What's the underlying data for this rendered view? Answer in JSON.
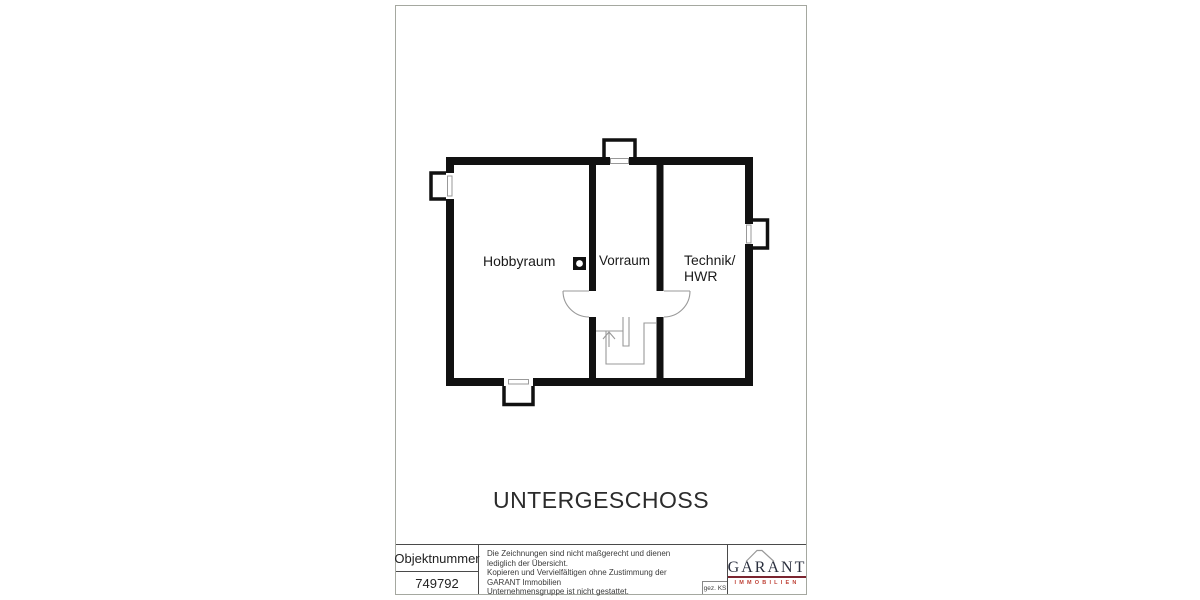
{
  "sheet": {
    "floor_label": "UNTERGESCHOSS",
    "rooms": {
      "hobbyraum": "Hobbyraum",
      "vorraum": "Vorraum",
      "technik_line1": "Technik/",
      "technik_line2": "HWR"
    },
    "symbols": [
      "chimney",
      "staircase-up-arrow",
      "door-swing-left",
      "door-swing-right",
      "window-top",
      "window-left",
      "window-right",
      "window-bottom"
    ]
  },
  "title_block": {
    "object_number_label": "Objektnummer",
    "object_number": "749792",
    "disclaimer_lines": {
      "0": "Die Zeichnungen sind nicht maßgerecht und dienen lediglich der Übersicht.",
      "1": "Kopieren und Vervielfältigen ohne Zustimmung der GARANT Immobilien",
      "2": "Unternehmensgruppe ist nicht gestattet."
    },
    "drawn_by": "gez. KS",
    "logo": {
      "brand": "GARANT",
      "subtitle": "IMMOBILIEN"
    }
  },
  "colors": {
    "wall": "#111111",
    "annotation_gray": "#999999",
    "sheet_border": "#a5a8a0",
    "logo_text": "#2a2f3e",
    "logo_underline": "#7b2530",
    "logo_subtitle_red": "#bf4136"
  }
}
